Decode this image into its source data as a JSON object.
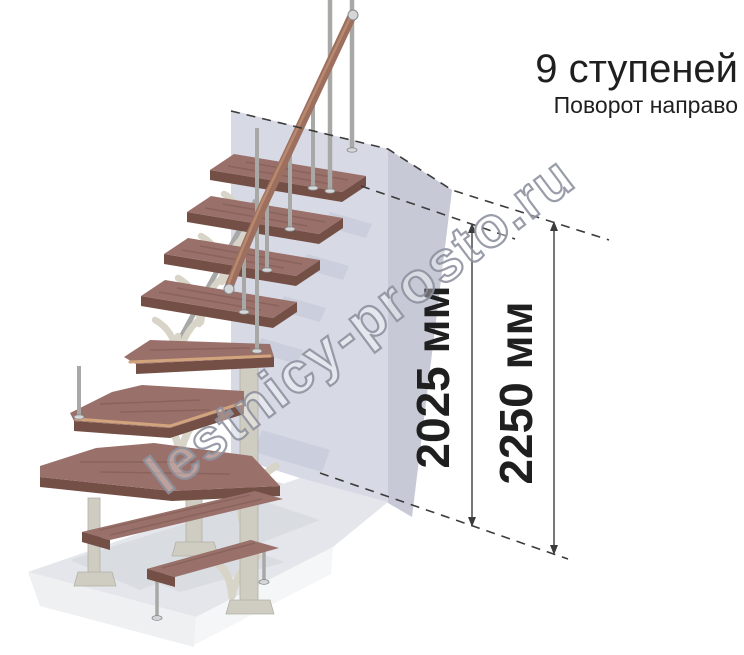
{
  "title": {
    "heading": "9 ступеней",
    "subtitle": "Поворот направо"
  },
  "stairs": {
    "steps_total": 9,
    "turn": "направо",
    "straight_steps_top": 4,
    "winder_steps": 3,
    "straight_steps_bottom": 2
  },
  "dimensions": [
    {
      "id": "height-to-last-step",
      "label": "2025 мм"
    },
    {
      "id": "floor-to-floor-height",
      "label": "2250 мм"
    }
  ],
  "watermark": {
    "text": "lestnicy-prosto.ru"
  },
  "colors": {
    "text": "#1f1f1f",
    "line": "#3c3c3c",
    "wall_front": "#d7dae5",
    "wall_side": "#c7cad6",
    "floor_top": "#e4e6eb",
    "floor_front_left": "#eef0f2",
    "floor_front_right": "#f5f6f8",
    "wood_top": "#99706a",
    "wood_dark": "#744f46",
    "wood_nosing": "#d2a47e",
    "wood_grain": "#6e4a41",
    "rail": "#9c6f5e",
    "rail_light": "#b9896f",
    "metal": "#a8a8a6",
    "metal_light": "#d4d6d8",
    "metal_edge": "#86898b",
    "bracket": "#d8d4c8",
    "column": "#cfccc2",
    "column_edge": "#b3b0a5",
    "shadow_wall": "#c3c7d5",
    "shadow_floor": "#d6d8de",
    "watermark_outline": "#8f93a0"
  }
}
